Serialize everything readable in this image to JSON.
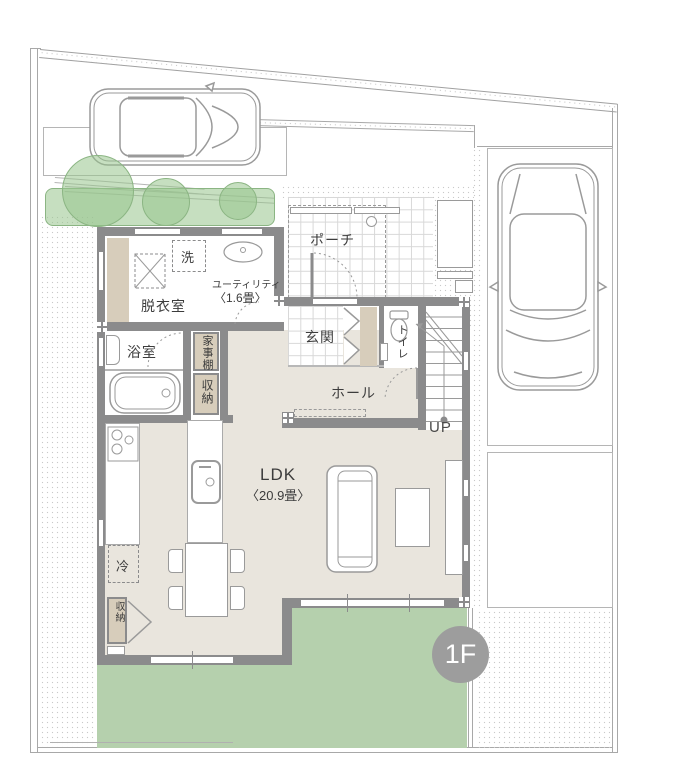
{
  "floor": {
    "badge": "1F"
  },
  "labels": {
    "porch": "ポーチ",
    "entrance": "玄関",
    "toilet": "トイレ",
    "hall": "ホール",
    "up": "UP",
    "ldk": "LDK",
    "ldk_size": "〈20.9畳〉",
    "laundry": "洗",
    "dressing_room": "脱衣室",
    "utility": "ユーティリティ",
    "utility_size": "〈1.6畳〉",
    "bath": "浴室",
    "household_shelf": "家事棚",
    "storage_hall": "収納",
    "storage_ldk": "収納",
    "fridge": "冷"
  },
  "colors": {
    "wall": "#8b8b8c",
    "floor_beige": "#e9e5dd",
    "cabinet_tan": "#d7cdbb",
    "lawn_green": "#b5d0ad",
    "tree_green": "#97c48d",
    "badge_gray": "#9d9d9d"
  }
}
